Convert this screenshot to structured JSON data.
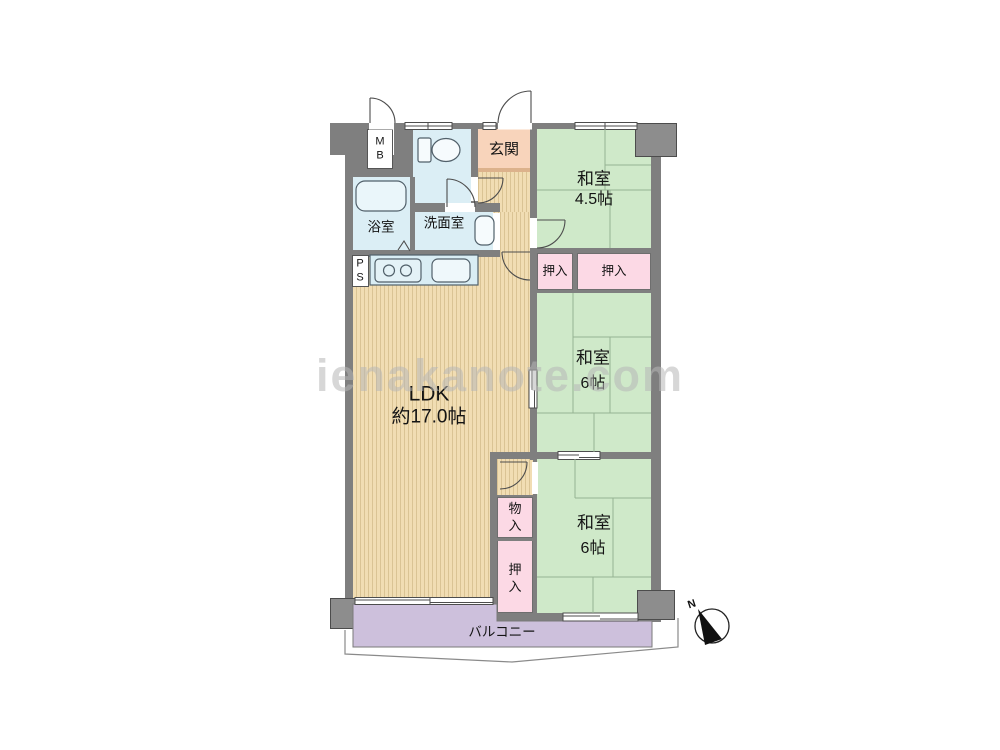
{
  "floorplan": {
    "watermark": "ienakanote.com",
    "compass": {
      "n_label": "N"
    },
    "rooms": {
      "entrance": {
        "label": "玄関"
      },
      "japanese_room_top": {
        "label": "和室",
        "size": "4.5帖"
      },
      "japanese_room_mid": {
        "label": "和室",
        "size": "6帖"
      },
      "japanese_room_bottom": {
        "label": "和室",
        "size": "6帖"
      },
      "ldk": {
        "label": "LDK",
        "size": "約17.0帖"
      },
      "bath": {
        "label": "浴室"
      },
      "washroom": {
        "label": "洗面室"
      },
      "balcony": {
        "label": "バルコニー"
      },
      "closet_top_left": {
        "label": "押入"
      },
      "closet_top_right": {
        "label": "押入"
      },
      "storage_small": {
        "label": "物入"
      },
      "closet_bottom": {
        "label": "押入"
      },
      "meter_box": {
        "label": "MB"
      },
      "pipe_shaft": {
        "label": "PS"
      }
    },
    "colors": {
      "wall": "#7f7f7f",
      "tatami_green": "#cfe9c9",
      "wood_floor": "#f1ddb3",
      "water_rooms_blue": "#dbeef5",
      "closet_pink": "#fcd9e5",
      "entrance_peach": "#f8d4bb",
      "balcony_lavender": "#cdc0dc"
    }
  }
}
